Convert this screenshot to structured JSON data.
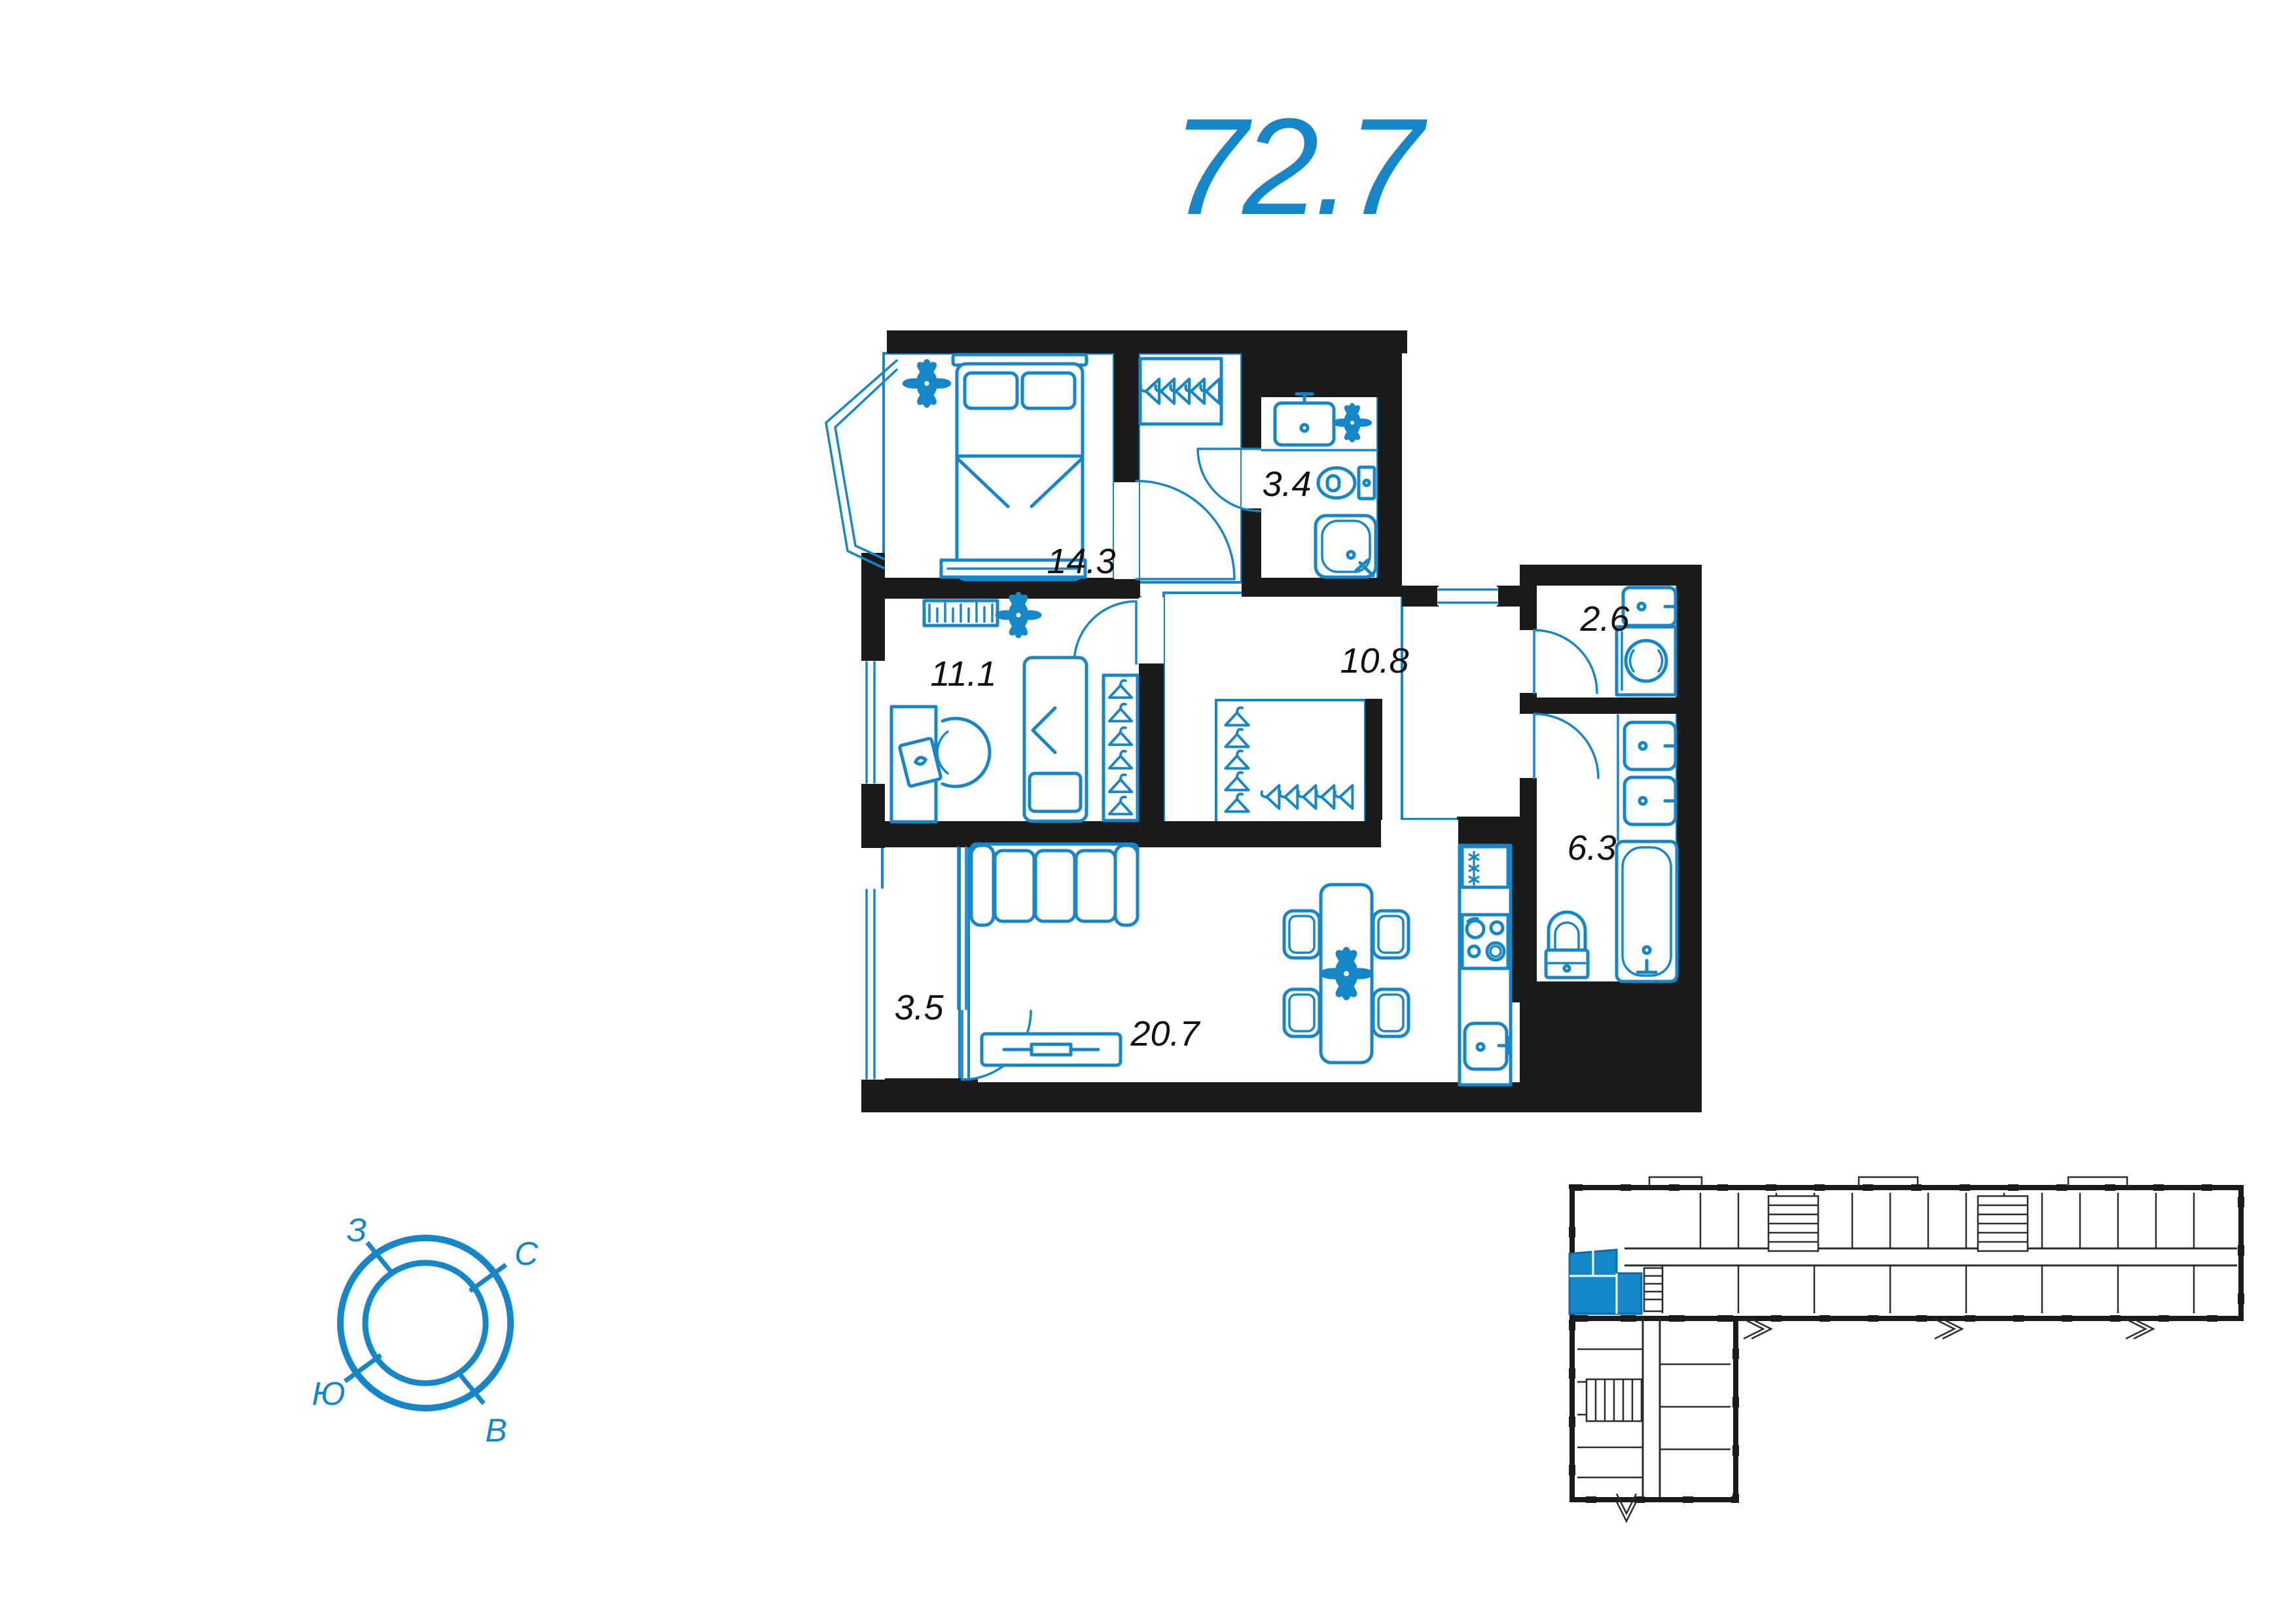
{
  "title": {
    "value": "72.7",
    "unit": "m2-total-area"
  },
  "floor_plan": {
    "rooms": [
      {
        "id": "bedroom",
        "area_label": "14.3"
      },
      {
        "id": "bathroom",
        "area_label": "3.4"
      },
      {
        "id": "hallway",
        "area_label": "10.8"
      },
      {
        "id": "bedroom-2",
        "area_label": "11.1"
      },
      {
        "id": "laundry",
        "area_label": "2.6"
      },
      {
        "id": "bathroom-2",
        "area_label": "6.3"
      },
      {
        "id": "loggia",
        "area_label": "3.5"
      },
      {
        "id": "living-kitchen",
        "area_label": "20.7"
      }
    ],
    "icons": [
      "double-bed",
      "single-bed",
      "wardrobe-hangers",
      "plant",
      "sink",
      "toilet",
      "shower",
      "washing-machine",
      "bathtub",
      "sofa",
      "tv-stand",
      "dining-table",
      "chair",
      "desk",
      "desk-chair",
      "fridge",
      "stove",
      "radiator-shelf",
      "door-arc"
    ]
  },
  "compass": {
    "north": "С",
    "east": "В",
    "south": "Ю",
    "west": "З"
  },
  "site_plan": {
    "highlighted_unit": true
  },
  "colors": {
    "accent": "#1587c9",
    "walls": "#1b1b1b",
    "label_text": "#101010"
  }
}
